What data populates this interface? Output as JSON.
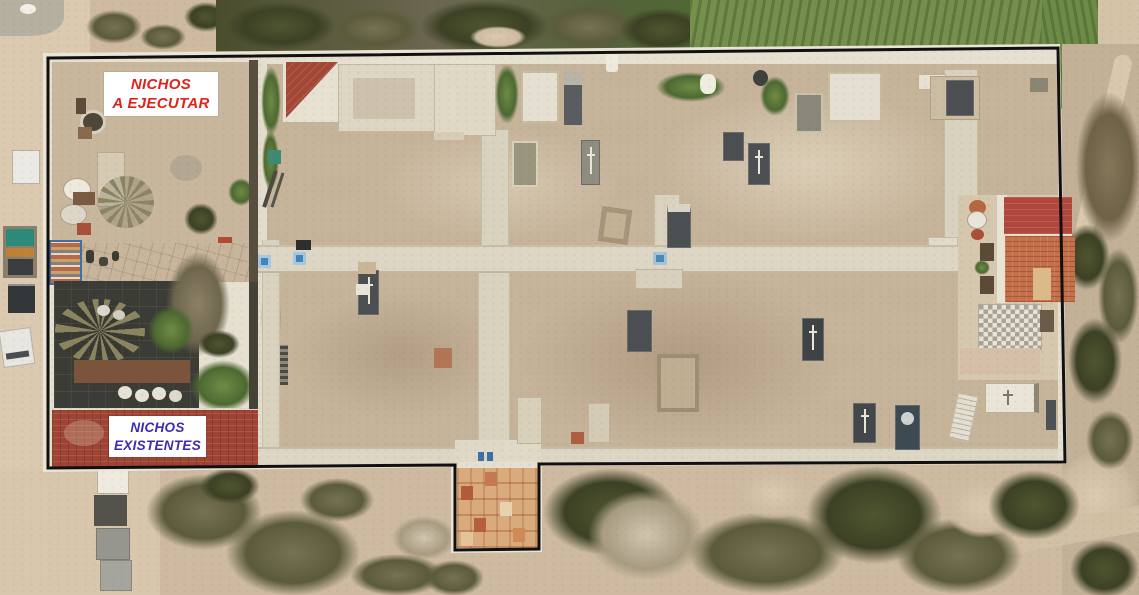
{
  "scene": {
    "type": "aerial-drone-photograph",
    "subject": "walled cemetery compound with annotated niche locations"
  },
  "annotations": {
    "boundary": {
      "name": "site-boundary",
      "stroke_color": "#101010"
    },
    "labels": [
      {
        "id": "nichos-a-ejecutar",
        "lines": [
          "NICHOS",
          "A EJECUTAR"
        ],
        "text_color": "#e0231a",
        "background": "#ffffff"
      },
      {
        "id": "nichos-existentes",
        "lines": [
          "NICHOS",
          "EXISTENTES"
        ],
        "text_color": "#3c2bb3",
        "background": "#ffffff"
      }
    ]
  },
  "palette": {
    "sand": "#cdbaa0",
    "road_sand": "#dbc9b0",
    "scrub_dark_green": "#3c4125",
    "scrub_olive": "#5b5b3b",
    "grass_green": "#74904c",
    "wall_white": "#e6e0d1",
    "path_concrete": "#ddd6c4",
    "roof_red_left": "#9e4434",
    "roof_red_right": "#b0473c",
    "roof_orange_tile": "#c4714b",
    "garden_paving_dark": "#3b3c35",
    "grave_dark": "#4b4f52",
    "entrance_tiles": "#d9ab7c",
    "marker_blue": "#3f86bd"
  }
}
